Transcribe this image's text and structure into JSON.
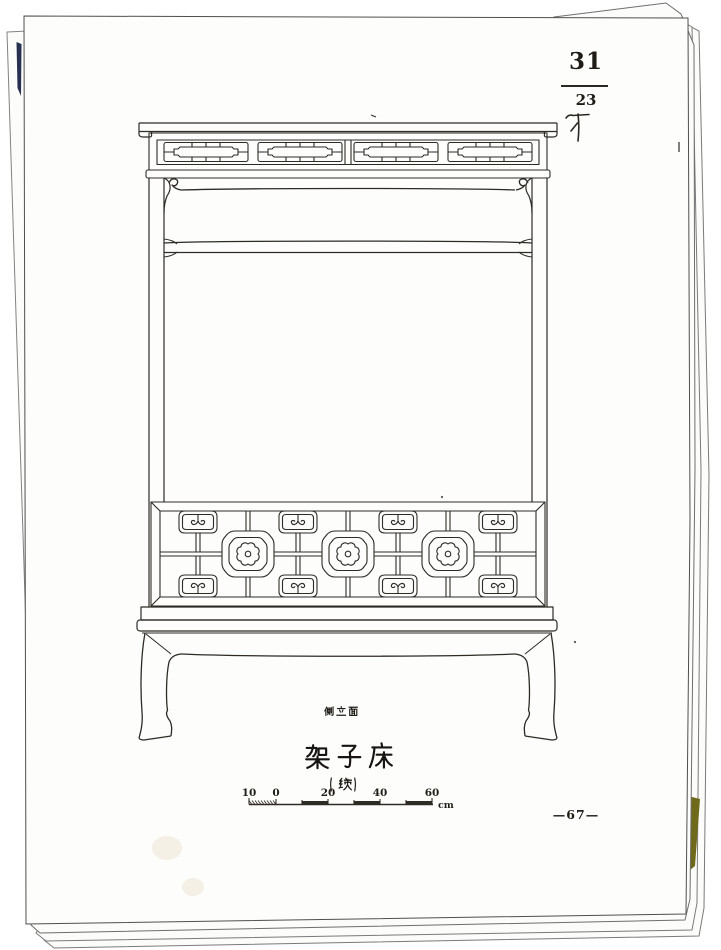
{
  "page": {
    "figure_number": "31",
    "plate_number": "23",
    "view_label": "侧立面",
    "title": "架子床",
    "title_note": "(续)",
    "page_number": "—67—"
  },
  "scale_bar": {
    "tick_labels": [
      "10",
      "0",
      "20",
      "40",
      "60"
    ],
    "unit": "cm"
  },
  "icons": {
    "drawing": "canopy-bed-side-elevation-line-drawing",
    "handwritten_mark": "pencil-tally-mark"
  },
  "colors": {
    "paper": "#fdfdfc",
    "ink": "#2e2b27",
    "navy_sliver": "#27304f",
    "olive_sliver": "#6f6a1a"
  }
}
